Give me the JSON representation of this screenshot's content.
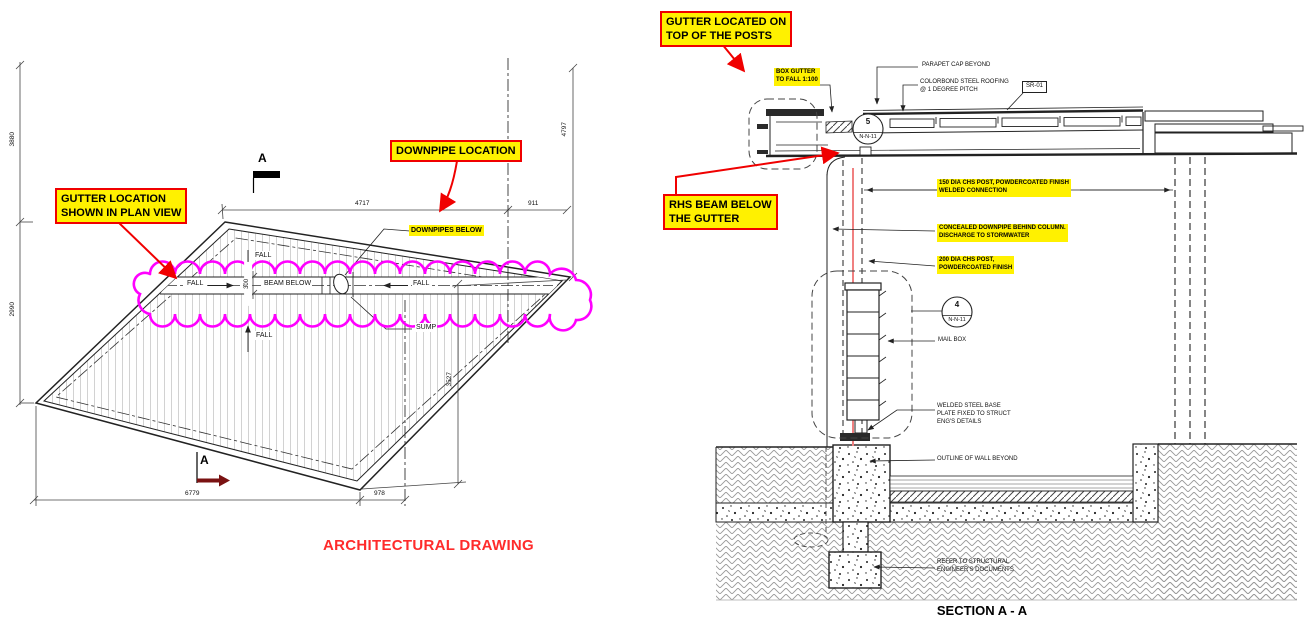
{
  "plan": {
    "callout_gutter": "GUTTER LOCATION\nSHOWN IN PLAN VIEW",
    "callout_downpipe": "DOWNPIPE LOCATION",
    "tag_downpipes_below": "DOWNPIPES BELOW",
    "marker_top": "A",
    "marker_bottom": "A",
    "dim_left_upper": "3880",
    "dim_left_lower": "2990",
    "dim_top": "4717",
    "dim_top_right": "911",
    "dim_right_upper": "4797",
    "dim_right_lower": "3527",
    "dim_bottom": "6779",
    "dim_bottom_right": "978",
    "dim_band": "300",
    "fall": "FALL",
    "beam_below": "BEAM BELOW",
    "sump": "SUMP",
    "title": "ARCHITECTURAL DRAWING"
  },
  "section": {
    "callout_gutter_top": "GUTTER LOCATED ON\nTOP OF THE POSTS",
    "callout_rhs_beam": "RHS BEAM BELOW\nTHE GUTTER",
    "box_gutter": "BOX GUTTER\nTO FALL 1:100",
    "parapet_cap": "PARAPET CAP BEYOND",
    "colorbond": "COLORBOND STEEL ROOFING\n@ 1 DEGREE PITCH",
    "sr01": "SR-01",
    "post150": "150 DIA CHS POST, POWDERCOATED FINISH\nWELDED CONNECTION",
    "concealed": "CONCEALED DOWNPIPE BEHIND COLUMN.\nDISCHARGE TO STORMWATER",
    "post200": "200 DIA CHS POST,\nPOWDERCOATED FINISH",
    "mail_box": "MAIL BOX",
    "welded_base": "WELDED STEEL BASE\nPLATE FIXED TO STRUCT\nENG'S DETAILS",
    "outline_wall": "OUTLINE OF WALL BEYOND",
    "refer_struct": "REFER TO STRUCTURAL\nENGINEER'S DOCUMENTS",
    "detail5": {
      "number": "5",
      "sheet": "N-N-11"
    },
    "detail4": {
      "number": "4",
      "sheet": "N-N-11"
    },
    "title": "SECTION A - A"
  },
  "colors": {
    "highlight": "#fff100",
    "callout_border": "#f00000",
    "revision_cloud": "#ff00ff",
    "red_title": "#ff2b2b",
    "downpipe_line": "#f08080",
    "section_arrow": "#7a1212"
  }
}
